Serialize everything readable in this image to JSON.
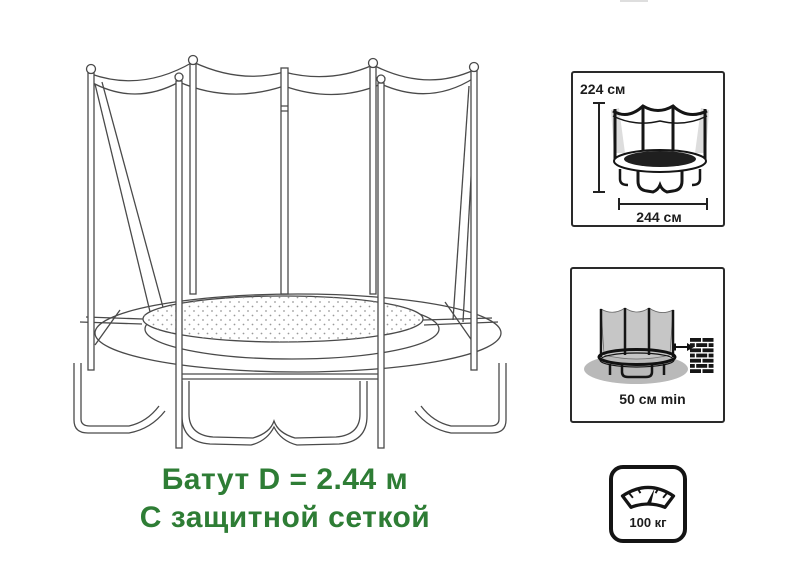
{
  "figure": {
    "caption_line1": "Батут D = 2.44 м",
    "caption_line2": "С защитной сеткой"
  },
  "boxes": {
    "dimensions": {
      "height_label": "224 см",
      "diameter_label": "244 см"
    },
    "clearance": {
      "min_distance_label": "50 см min"
    },
    "weight": {
      "max_load_label": "100 кг"
    }
  },
  "colors": {
    "caption_green": "#2e7d35",
    "line_art_gray": "#4a4a4a",
    "icon_black": "#141414",
    "box_border": "#2a2a2a",
    "net_fill_gray": "#c6c6c6",
    "shadow_gray": "#b9b9b9",
    "mat_dark": "#1f1f1f"
  },
  "icons": {
    "main_illustration": "trampoline-with-safety-net-line-art",
    "dimensions_icon": "trampoline-dimensions-icon",
    "clearance_icon": "trampoline-wall-clearance-icon",
    "wall_icon": "brick-wall-icon",
    "arrow_icon": "right-arrow-icon",
    "weight_icon": "weight-scale-icon"
  }
}
